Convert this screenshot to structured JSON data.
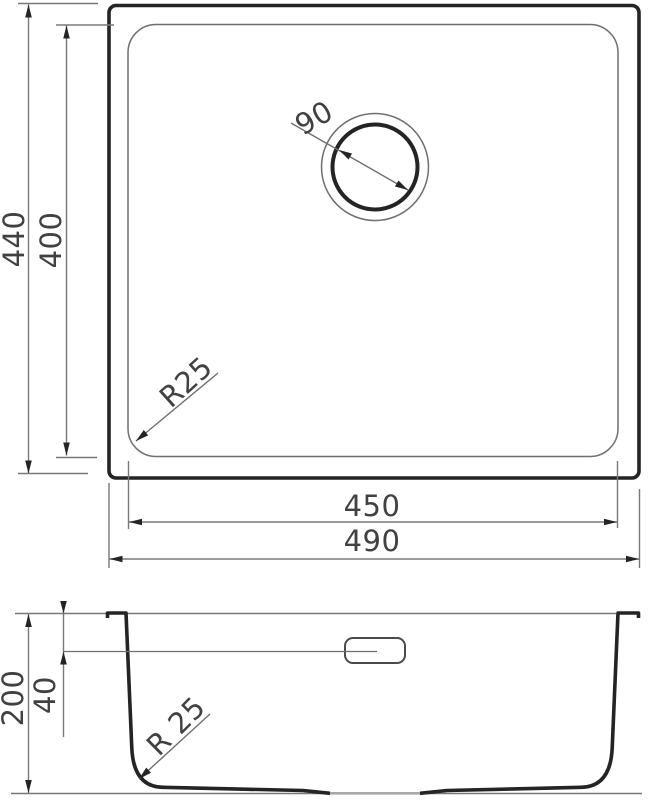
{
  "drawing": {
    "type": "sink-technical-drawing",
    "views": {
      "top_view": {
        "labels": {
          "overall_height": "440",
          "basin_height": "400",
          "drain_diameter": "90",
          "corner_radius": "R25",
          "basin_width": "450",
          "overall_width": "490"
        }
      },
      "section_view": {
        "labels": {
          "depth": "200",
          "overflow_offset": "40",
          "bottom_radius": "R 25"
        }
      }
    },
    "dimensions_mm": {
      "overall_width": 490,
      "overall_depth": 440,
      "basin_width": 450,
      "basin_depth": 400,
      "drain_diameter": 90,
      "corner_radius": 25,
      "bowl_height": 200,
      "overflow_below_rim": 40,
      "bottom_corner_radius": 25
    },
    "colors": {
      "outline": "#242424",
      "thin_line": "#6f6f6f",
      "dim_line": "#787878",
      "recess_line": "#a8a8a8",
      "text": "#414141",
      "background": "#ffffff"
    }
  }
}
